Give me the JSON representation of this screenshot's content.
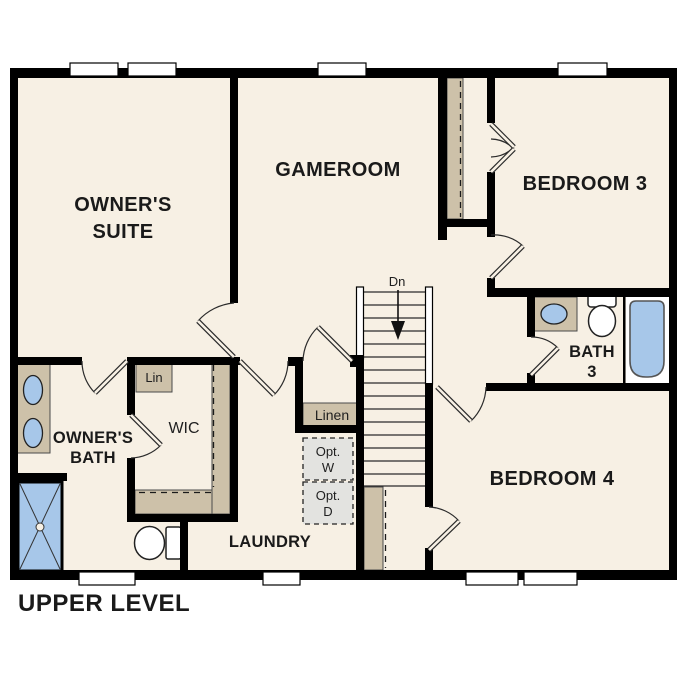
{
  "title": "UPPER LEVEL",
  "colors": {
    "floor": "#F7F0E4",
    "wall": "#000000",
    "closet": "#CDC1A9",
    "fixture_blue": "#A7C7E9",
    "opt_box": "#E3E3E0",
    "window_fill": "#FFFFFF",
    "text": "#1A1A1A"
  },
  "rooms": {
    "owners_suite": [
      "OWNER'S",
      "SUITE"
    ],
    "gameroom": "GAMEROOM",
    "bedroom3": "BEDROOM 3",
    "bedroom4": "BEDROOM 4",
    "owners_bath": [
      "OWNER'S",
      "BATH"
    ],
    "bath3": [
      "BATH",
      "3"
    ],
    "laundry": "LAUNDRY",
    "wic": "WIC"
  },
  "closets": {
    "lin": "Lin",
    "linen": "Linen"
  },
  "stairs": {
    "down_label": "Dn"
  },
  "optional_appliances": {
    "washer": [
      "Opt.",
      "W"
    ],
    "dryer": [
      "Opt.",
      "D"
    ]
  }
}
